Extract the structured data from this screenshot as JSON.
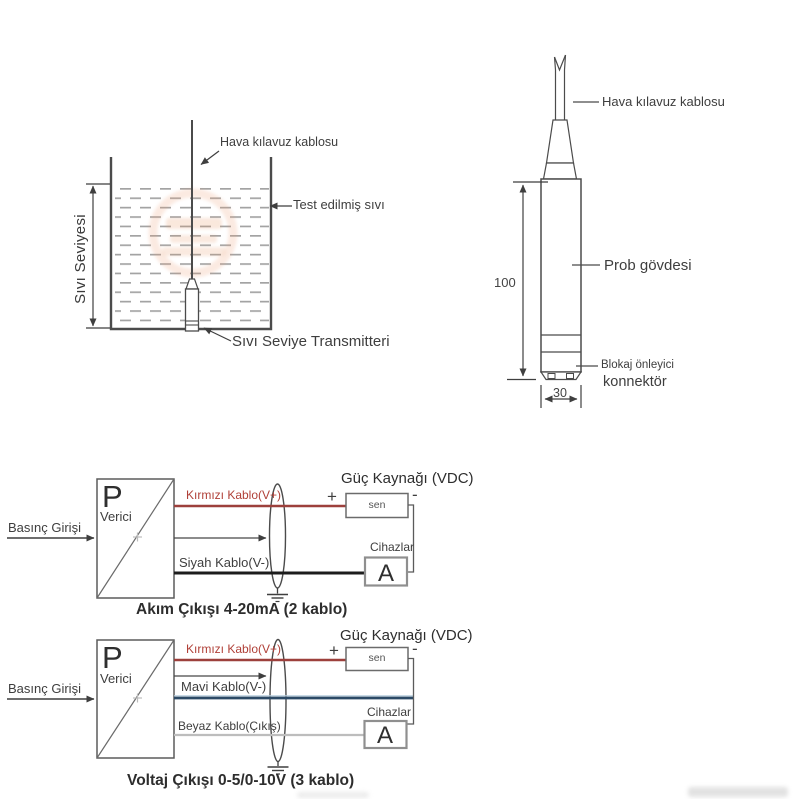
{
  "colors": {
    "line": "#4b4b4b",
    "red_wire": "#9d403c",
    "red_label": "#b04038",
    "black_wire": "#1d1d1d",
    "blue_wire": "#2c4a66",
    "white_wire": "#bdbdbd",
    "watermark_orange": "#e8935f"
  },
  "tank": {
    "air_cable_label": "Hava kılavuz kablosu",
    "tested_liquid_label": "Test edilmiş sıvı",
    "level_label": "Sıvı Seviyesi",
    "transmitter_label": "Sıvı Seviye Transmitteri"
  },
  "probe": {
    "air_cable_label": "Hava kılavuz kablosu",
    "body_label": "Prob gövdesi",
    "connector_label_1": "Blokaj önleyici",
    "connector_label_2": "konnektör",
    "height_dim": "100",
    "width_dim": "30"
  },
  "current_circuit": {
    "input_label": "Basınç Girişi",
    "p_symbol": "P",
    "transmitter_word": "Verici",
    "red_wire_label": "Kırmızı Kablo(V+)",
    "black_wire_label": "Siyah Kablo(V-)",
    "supply_title": "Güç Kaynağı (VDC)",
    "plus": "+",
    "minus": "-",
    "supply_text": "sen",
    "devices_label": "Cihazlar",
    "ammeter_symbol": "A",
    "caption": "Akım Çıkışı 4-20mA (2 kablo)"
  },
  "voltage_circuit": {
    "input_label": "Basınç Girişi",
    "p_symbol": "P",
    "transmitter_word": "Verici",
    "red_wire_label": "Kırmızı Kablo(V+)",
    "blue_wire_label": "Mavi Kablo(V-)",
    "white_wire_label": "Beyaz Kablo(Çıkış)",
    "supply_title": "Güç Kaynağı (VDC)",
    "plus": "+",
    "minus": "-",
    "supply_text": "sen",
    "devices_label": "Cihazlar",
    "ammeter_symbol": "A",
    "caption": "Voltaj Çıkışı 0-5/0-10V (3 kablo)"
  }
}
